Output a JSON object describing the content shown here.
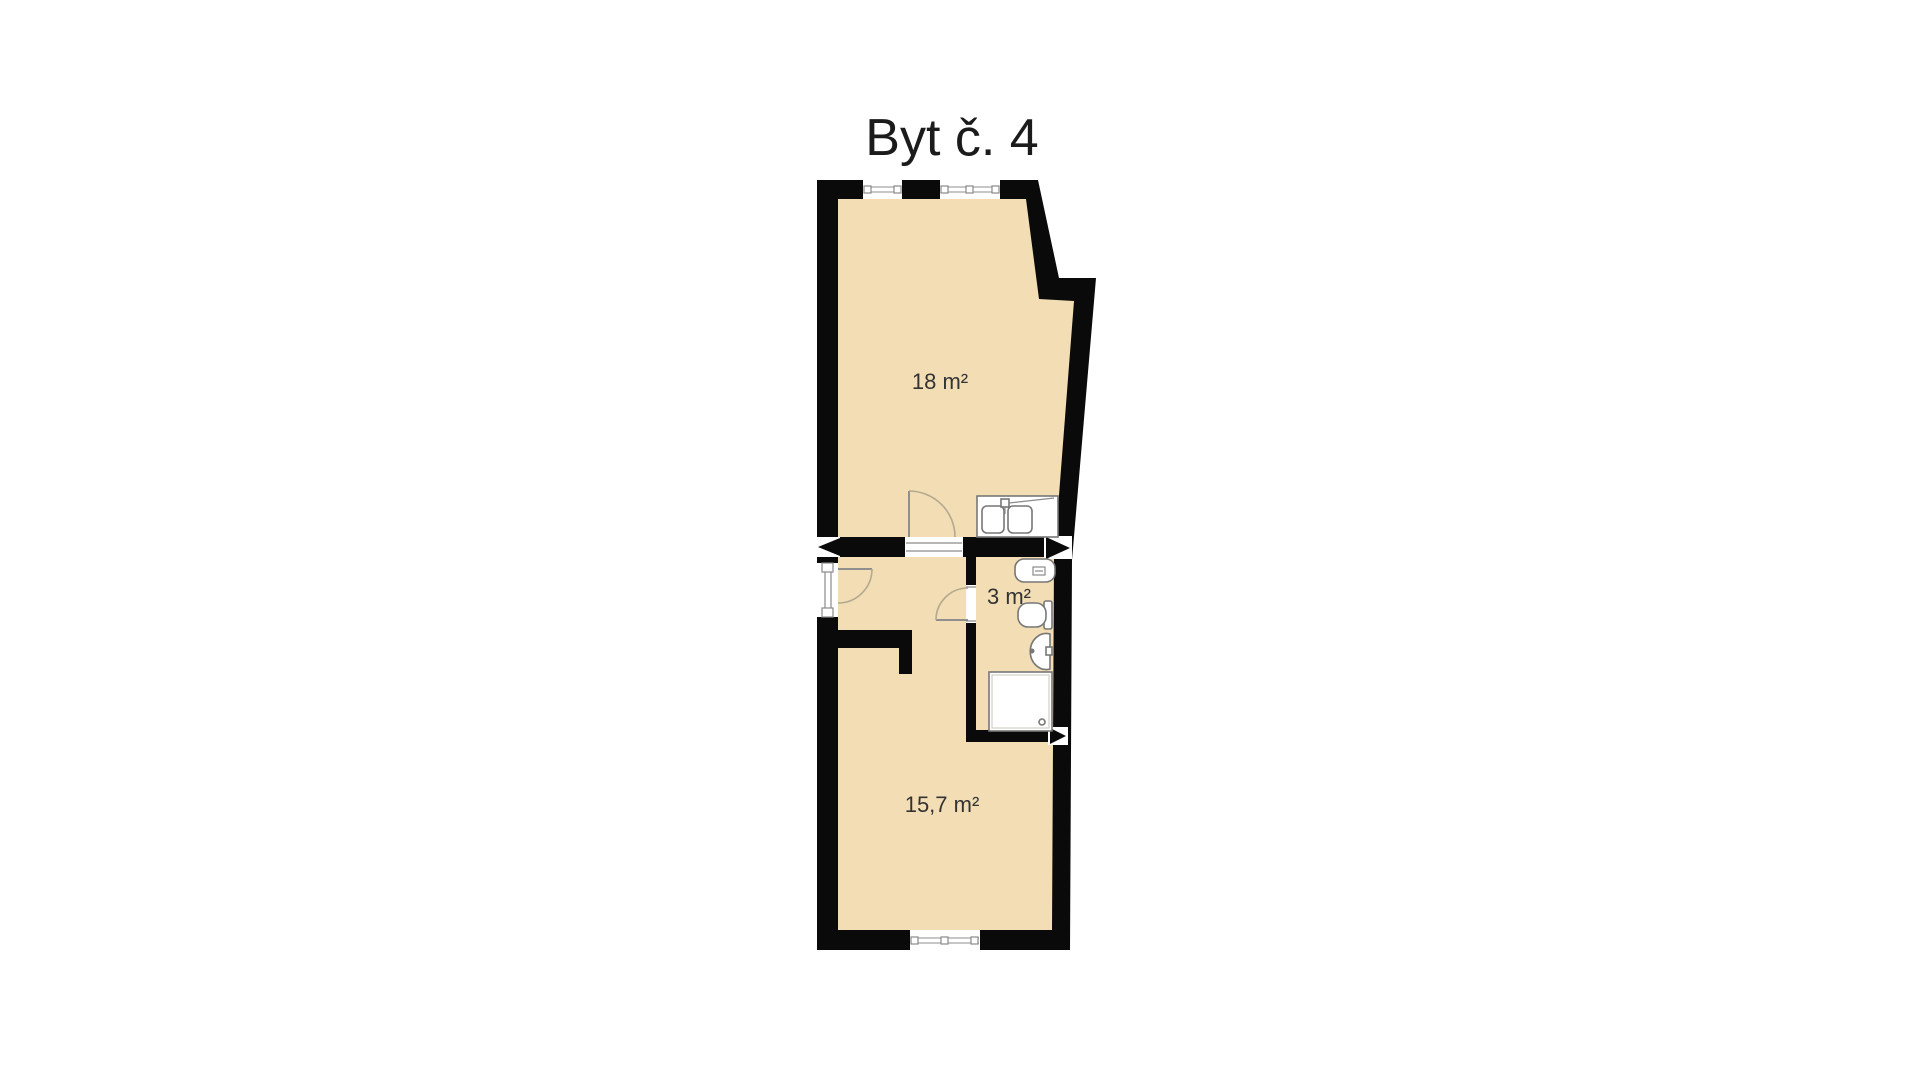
{
  "title": "Byt č. 4",
  "plan": {
    "rooms": [
      {
        "id": "room-top",
        "area_label": "18 m²"
      },
      {
        "id": "bathroom",
        "area_label": "3 m²"
      },
      {
        "id": "room-bottom",
        "area_label": "15,7 m²"
      }
    ],
    "fixture_icons": [
      "kitchen-sink-icon",
      "boiler-icon",
      "toilet-icon",
      "washbasin-icon",
      "shower-icon"
    ],
    "opening_icons": [
      "window-top-left-icon",
      "window-top-right-icon",
      "window-bottom-icon",
      "entrance-door-icon",
      "room-door-icon",
      "bathroom-door-icon"
    ]
  },
  "colors": {
    "background": "#ffffff",
    "wall": "#0a0a0a",
    "floor": "#f2ddb4",
    "door_arc": "#b3a98f",
    "title_text": "#1b1b1b"
  }
}
